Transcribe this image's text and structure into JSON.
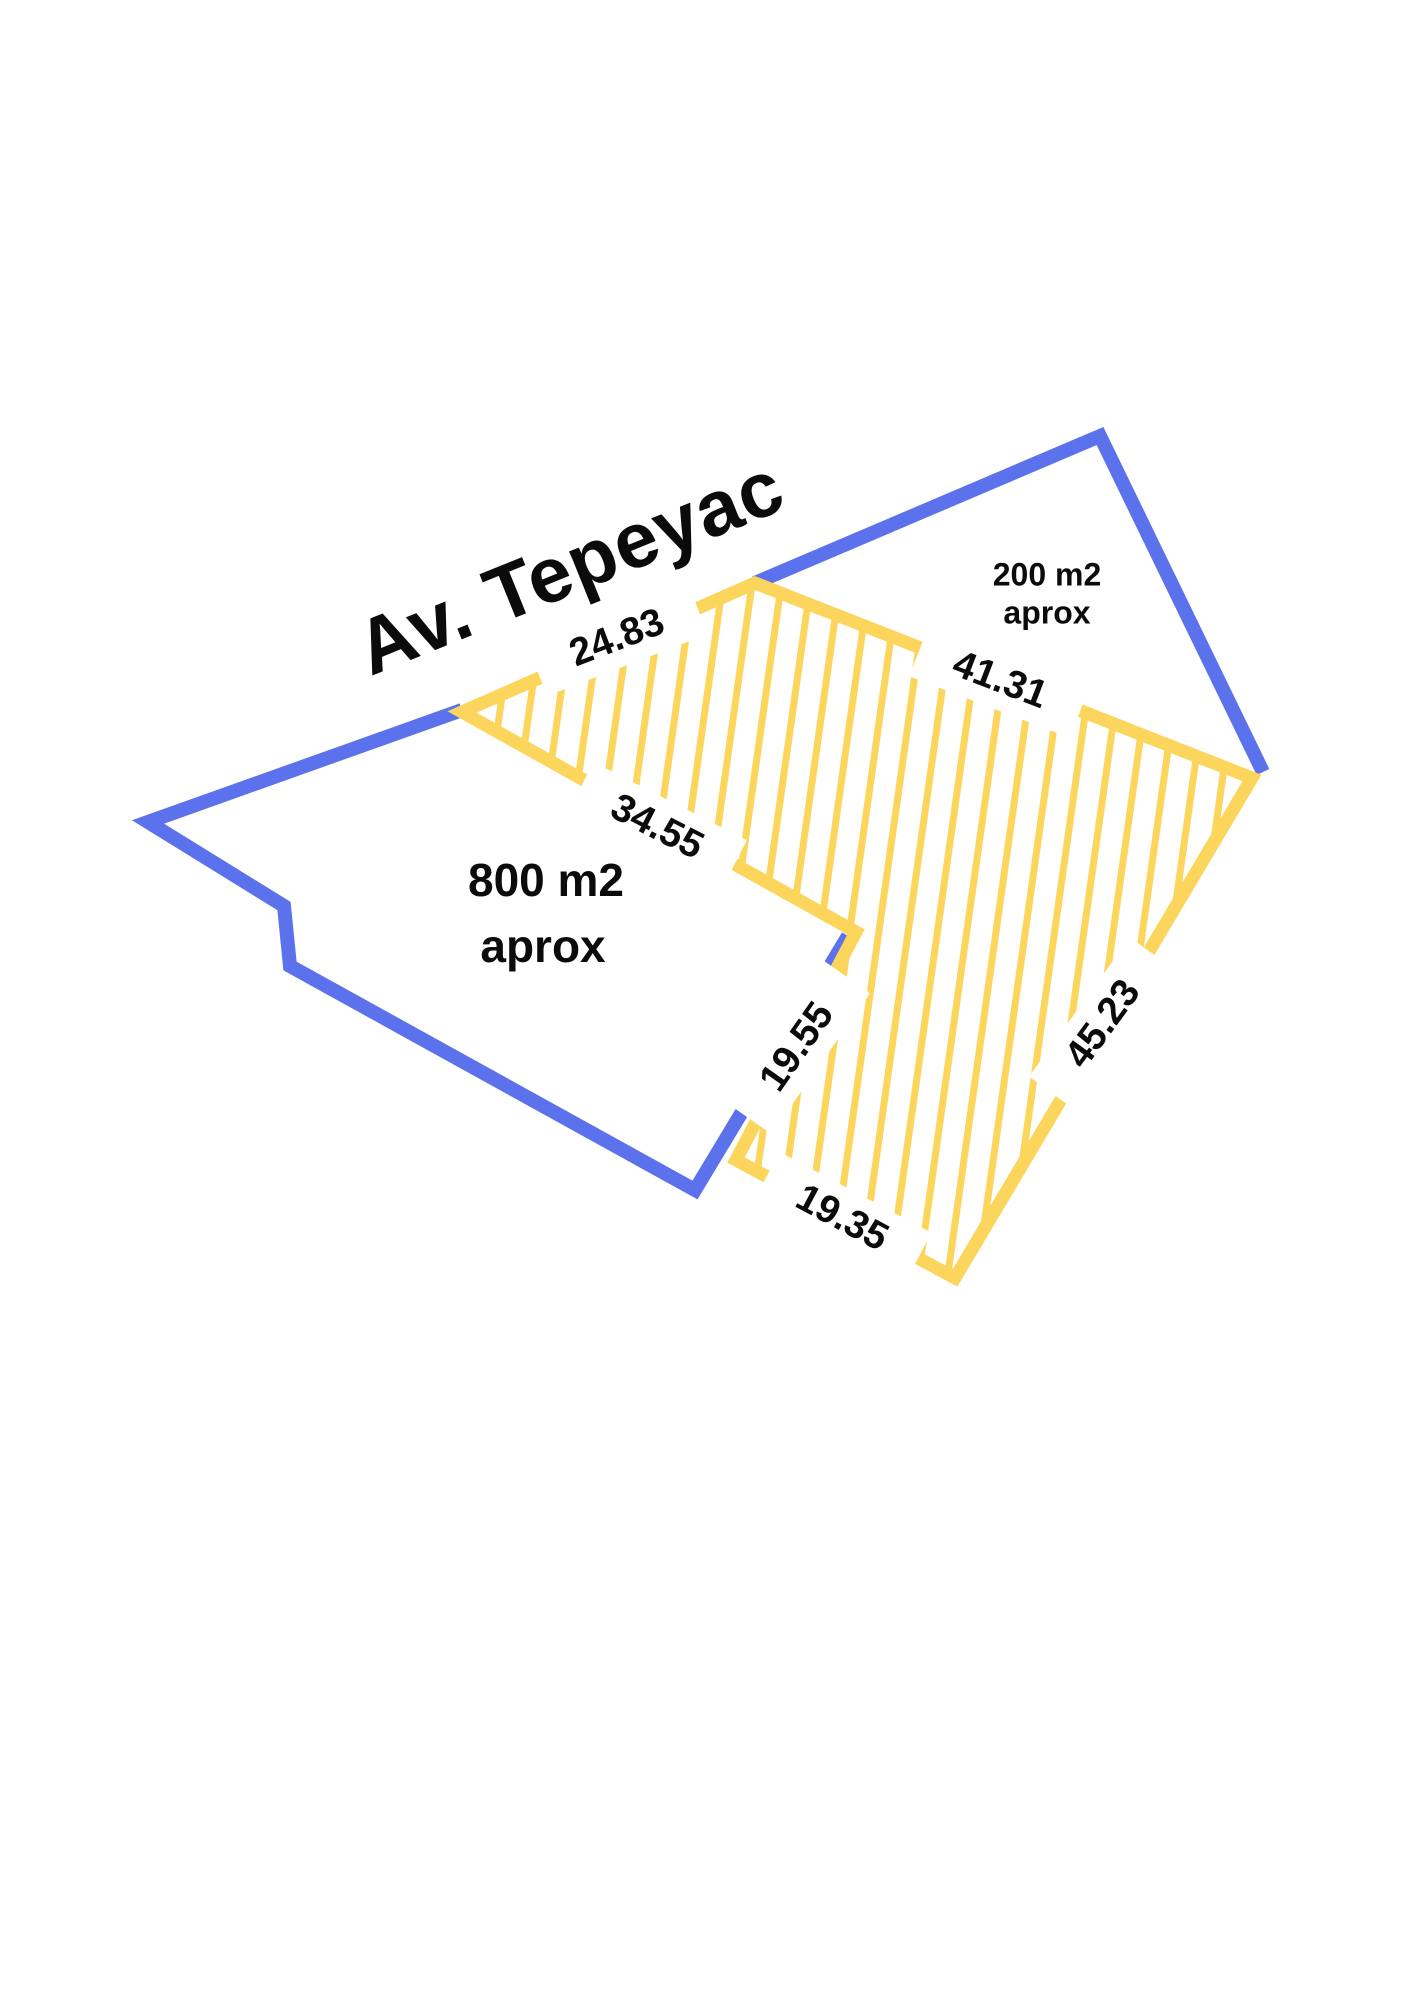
{
  "title": "Av. Tepeyac",
  "colors": {
    "boundary_blue": "#5B72EC",
    "parcel_yellow": "#FBD55C",
    "text_black": "#0B0B0B",
    "background": "#FFFFFF"
  },
  "parcels": [
    {
      "id": "left-parcel",
      "area_label": "800 m2",
      "area_note": "aprox"
    },
    {
      "id": "right-parcel",
      "area_label": "200 m2",
      "area_note": "aprox"
    }
  ],
  "measurements": [
    {
      "id": "seg-24-83",
      "value": "24.83"
    },
    {
      "id": "seg-41-31",
      "value": "41.31"
    },
    {
      "id": "seg-34-55",
      "value": "34.55"
    },
    {
      "id": "seg-19-55",
      "value": "19.55"
    },
    {
      "id": "seg-45-23",
      "value": "45.23"
    },
    {
      "id": "seg-19-35",
      "value": "19.35"
    }
  ]
}
